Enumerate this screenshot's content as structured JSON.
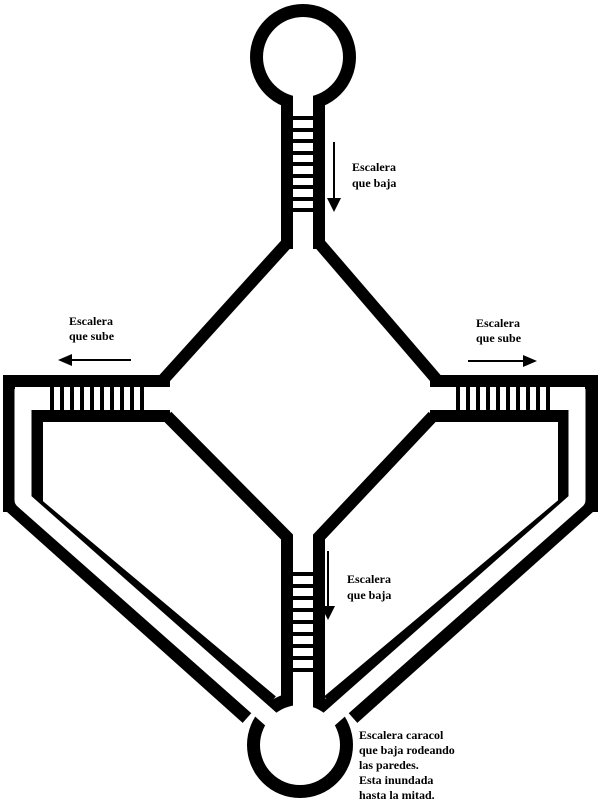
{
  "map": {
    "colors": {
      "ink": "#000000",
      "background": "#ffffff"
    },
    "labels": {
      "top_stair": [
        "Escalera",
        "que baja"
      ],
      "left_stair": [
        "Escalera",
        "que sube"
      ],
      "right_stair": [
        "Escalera",
        "que sube"
      ],
      "center_stair": [
        "Escalera",
        "que baja"
      ],
      "spiral_stair_note": [
        "Escalera caracol",
        "que baja rodeando",
        "las paredes.",
        "Esta inundada",
        "hasta la mitad."
      ]
    },
    "arrows": {
      "top_stair": "down",
      "left_stair": "left",
      "right_stair": "right",
      "center_stair": "down"
    }
  }
}
